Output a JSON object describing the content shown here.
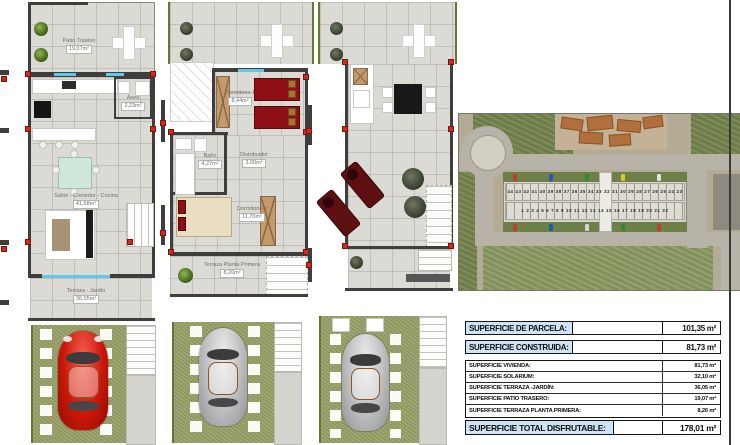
{
  "plans": {
    "ground": {
      "labels": {
        "patio": {
          "name": "Patio Trasero",
          "area": "19,07m²"
        },
        "aseo": {
          "name": "Aseo",
          "area": "2,23m²"
        },
        "salon": {
          "name": "Salón - Comedor - Cocina",
          "area": "41,58m²"
        },
        "terraza": {
          "name": "Terraza - Jardín",
          "area": "36,05m²"
        }
      }
    },
    "first": {
      "labels": {
        "dormitorio1": {
          "name": "Dormitorio 1",
          "area": "8,44m²"
        },
        "bano": {
          "name": "Baño",
          "area": "4,27m²"
        },
        "distribuidor": {
          "name": "Distribuidor",
          "area": "3,00m²"
        },
        "dormitorio2": {
          "name": "Dormitorio 2",
          "area": "11,70m²"
        },
        "terraza": {
          "name": "Terraza Planta Primera",
          "area": "8,26m²"
        }
      }
    },
    "solarium": {
      "labels": {}
    }
  },
  "aerial": {
    "unit_numbers_top": "44 43 42 41 40 39 38 37 36 35 34 33 32 31 30 29 28 27 26 25 24 23",
    "unit_numbers_bottom": "1 2 3 4 5 6 7 8 9 10 11 12 13 14 15 16 17 18 19 20 21 22",
    "car_colors": [
      "#c23a2e",
      "#2a52b8",
      "#2c8a2c",
      "#d8cc2a",
      "#e8e8e8",
      "#c23a2e",
      "#1a5cb0",
      "#d9d9d9",
      "#2c8a2c",
      "#c23a2e"
    ]
  },
  "table": {
    "primary": [
      {
        "label": "SUPERFICIE DE PARCELA:",
        "value": "101,35 m²"
      },
      {
        "label": "SUPERFICIE CONSTRUIDA:",
        "value": "81,73 m²"
      }
    ],
    "details": [
      {
        "label": "SUPERFICIE VIVIENDA:",
        "value": "81,73 m²"
      },
      {
        "label": "SUPERFICIE SOLARIUM:",
        "value": "32,10 m²"
      },
      {
        "label": "SUPERFICIE TERRAZA -JARDÍN:",
        "value": "36,05 m²"
      },
      {
        "label": "SUPERFICIE PATIO TRASERO:",
        "value": "19,07 m²"
      },
      {
        "label": "SUPERFICIE TERRAZA PLANTA PRIMERA:",
        "value": "8,26 m²"
      }
    ],
    "total": {
      "label": "SUPERFICIE TOTAL DISFRUTABLE:",
      "value": "178,01 m²"
    }
  },
  "colors": {
    "table_label_bg": "#cfe3f4",
    "wall": "#3f3e3c",
    "grass": "#9ea56e",
    "red_car": "#cc170a",
    "bed_red": "#8e1016",
    "wood": "#c49a6c",
    "window_glass": "#63c7e8"
  }
}
